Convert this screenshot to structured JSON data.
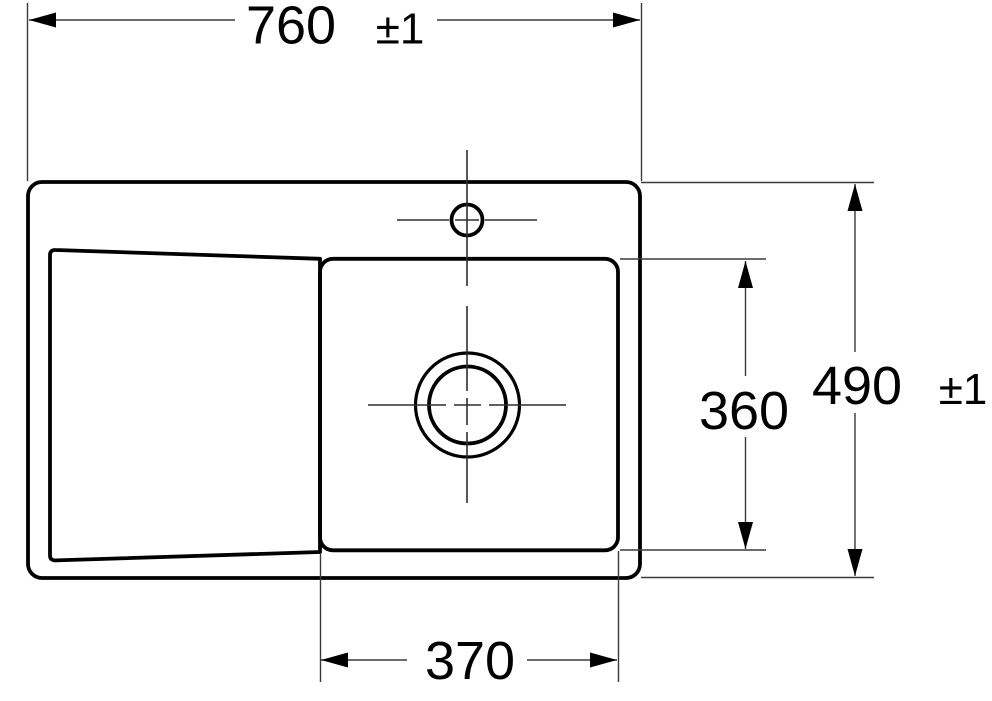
{
  "diagram": {
    "type": "technical-drawing-sink-top-view",
    "background_color": "#ffffff",
    "outline_color": "#000000",
    "thin_line_color": "#3a3a3a",
    "dimensions": {
      "overall_width": {
        "value": "760",
        "tolerance": "±1"
      },
      "overall_depth": {
        "value": "490",
        "tolerance": "±1"
      },
      "bowl_depth": {
        "value": "360"
      },
      "bowl_width": {
        "value": "370"
      }
    }
  }
}
